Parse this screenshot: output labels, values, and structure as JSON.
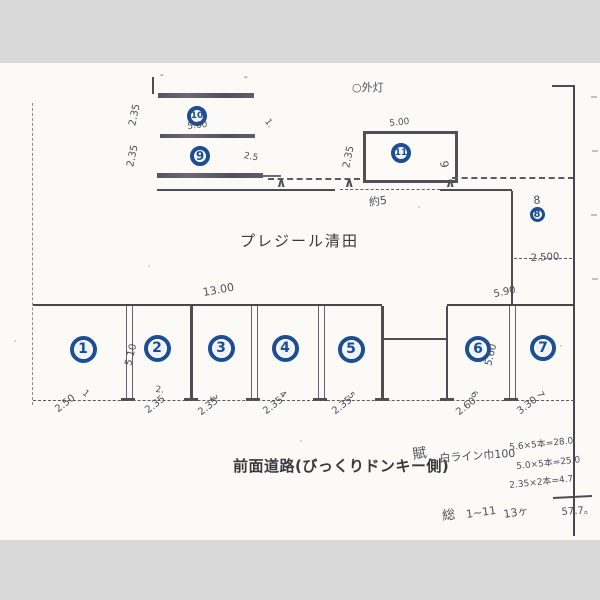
{
  "colors": {
    "paper": "#fbfaf6",
    "scan_background": "#d9d9d9",
    "line": "#4c4c53",
    "marker_blue": "#1d4d92",
    "handwriting": "#4a505b",
    "printed_text": "#38383e"
  },
  "labels": {
    "building": "プレジール清田",
    "road": "前面道路(びっくりドンキー側)"
  },
  "markers": [
    {
      "n": "1",
      "cx": 83,
      "cy": 349,
      "d": 27,
      "fs": 14
    },
    {
      "n": "2",
      "cx": 157,
      "cy": 348,
      "d": 27,
      "fs": 14
    },
    {
      "n": "3",
      "cx": 221,
      "cy": 348,
      "d": 27,
      "fs": 14
    },
    {
      "n": "4",
      "cx": 285,
      "cy": 348,
      "d": 27,
      "fs": 14
    },
    {
      "n": "5",
      "cx": 351,
      "cy": 349,
      "d": 27,
      "fs": 14
    },
    {
      "n": "6",
      "cx": 478,
      "cy": 349,
      "d": 26,
      "fs": 14
    },
    {
      "n": "7",
      "cx": 543,
      "cy": 348,
      "d": 26,
      "fs": 14
    },
    {
      "n": "8",
      "cx": 538,
      "cy": 215,
      "d": 17,
      "fs": 10
    },
    {
      "n": "9",
      "cx": 200,
      "cy": 156,
      "d": 20,
      "fs": 12
    },
    {
      "n": "10",
      "cx": 197,
      "cy": 116,
      "d": 20,
      "fs": 9
    },
    {
      "n": "11",
      "cx": 401,
      "cy": 153,
      "d": 20,
      "fs": 9
    }
  ],
  "annotations": [
    {
      "text": "-",
      "x": 160,
      "y": 80,
      "rot": 0,
      "size": 10
    },
    {
      "text": "-",
      "x": 244,
      "y": 82,
      "rot": 0,
      "size": 10
    },
    {
      "text": "2.35",
      "x": 138,
      "y": 126,
      "rot": -78,
      "size": 10
    },
    {
      "text": "2.35",
      "x": 136,
      "y": 167,
      "rot": -78,
      "size": 10
    },
    {
      "text": "5.00",
      "x": 188,
      "y": 131,
      "rot": -6,
      "size": 9
    },
    {
      "text": "1.",
      "x": 262,
      "y": 122,
      "rot": 55,
      "size": 9
    },
    {
      "text": "2.5",
      "x": 243,
      "y": 160,
      "rot": 10,
      "size": 9
    },
    {
      "text": "○外灯",
      "x": 352,
      "y": 90,
      "rot": 0,
      "size": 11
    },
    {
      "text": "5.00",
      "x": 390,
      "y": 128,
      "rot": -6,
      "size": 9
    },
    {
      "text": "2.35",
      "x": 352,
      "y": 168,
      "rot": -78,
      "size": 10
    },
    {
      "text": "9",
      "x": 437,
      "y": 160,
      "rot": 80,
      "size": 11
    },
    {
      "text": "約5",
      "x": 370,
      "y": 205,
      "rot": -8,
      "size": 11
    },
    {
      "text": "8",
      "x": 534,
      "y": 205,
      "rot": -5,
      "size": 11
    },
    {
      "text": "2.500",
      "x": 531,
      "y": 263,
      "rot": -3,
      "size": 10
    },
    {
      "text": "13.00",
      "x": 204,
      "y": 297,
      "rot": -10,
      "size": 11
    },
    {
      "text": "5.90",
      "x": 495,
      "y": 299,
      "rot": -12,
      "size": 10
    },
    {
      "text": "5.10",
      "x": 134,
      "y": 366,
      "rot": -76,
      "size": 10
    },
    {
      "text": "5.60",
      "x": 494,
      "y": 366,
      "rot": -76,
      "size": 10
    },
    {
      "text": "1",
      "x": 80,
      "y": 395,
      "rot": 40,
      "size": 9
    },
    {
      "text": "2.",
      "x": 155,
      "y": 394,
      "rot": 5,
      "size": 9
    },
    {
      "text": "3",
      "x": 207,
      "y": 396,
      "rot": 70,
      "size": 9
    },
    {
      "text": "4",
      "x": 277,
      "y": 396,
      "rot": 40,
      "size": 9
    },
    {
      "text": "5",
      "x": 345,
      "y": 396,
      "rot": 50,
      "size": 9
    },
    {
      "text": "6",
      "x": 468,
      "y": 395,
      "rot": 50,
      "size": 9
    },
    {
      "text": "7",
      "x": 534,
      "y": 394,
      "rot": 60,
      "size": 9
    },
    {
      "text": "2.50",
      "x": 60,
      "y": 414,
      "rot": -38,
      "size": 10
    },
    {
      "text": "2.35",
      "x": 150,
      "y": 415,
      "rot": -38,
      "size": 10
    },
    {
      "text": "2.35",
      "x": 203,
      "y": 417,
      "rot": -38,
      "size": 10
    },
    {
      "text": "2.35",
      "x": 268,
      "y": 416,
      "rot": -38,
      "size": 10
    },
    {
      "text": "2.35",
      "x": 337,
      "y": 416,
      "rot": -38,
      "size": 10
    },
    {
      "text": "2.60",
      "x": 461,
      "y": 417,
      "rot": -38,
      "size": 10
    },
    {
      "text": "3.30",
      "x": 522,
      "y": 416,
      "rot": -38,
      "size": 10
    },
    {
      "text": "賦",
      "x": 414,
      "y": 458,
      "rot": -8,
      "size": 14
    },
    {
      "text": "白ライン巾100",
      "x": 440,
      "y": 461,
      "rot": -4,
      "size": 11
    },
    {
      "text": "5.6×5本=28.0",
      "x": 510,
      "y": 449,
      "rot": -6,
      "size": 9
    },
    {
      "text": "5.0×5本=25.0",
      "x": 517,
      "y": 468,
      "rot": -6,
      "size": 9
    },
    {
      "text": "2.35×2本=4.7",
      "x": 510,
      "y": 487,
      "rot": -6,
      "size": 9
    },
    {
      "text": "57.7。",
      "x": 562,
      "y": 513,
      "rot": -4,
      "size": 10
    },
    {
      "text": "総",
      "x": 443,
      "y": 518,
      "rot": -6,
      "size": 13
    },
    {
      "text": "1~11",
      "x": 467,
      "y": 519,
      "rot": -8,
      "size": 11
    },
    {
      "text": "13ヶ",
      "x": 505,
      "y": 517,
      "rot": -10,
      "size": 11
    }
  ]
}
